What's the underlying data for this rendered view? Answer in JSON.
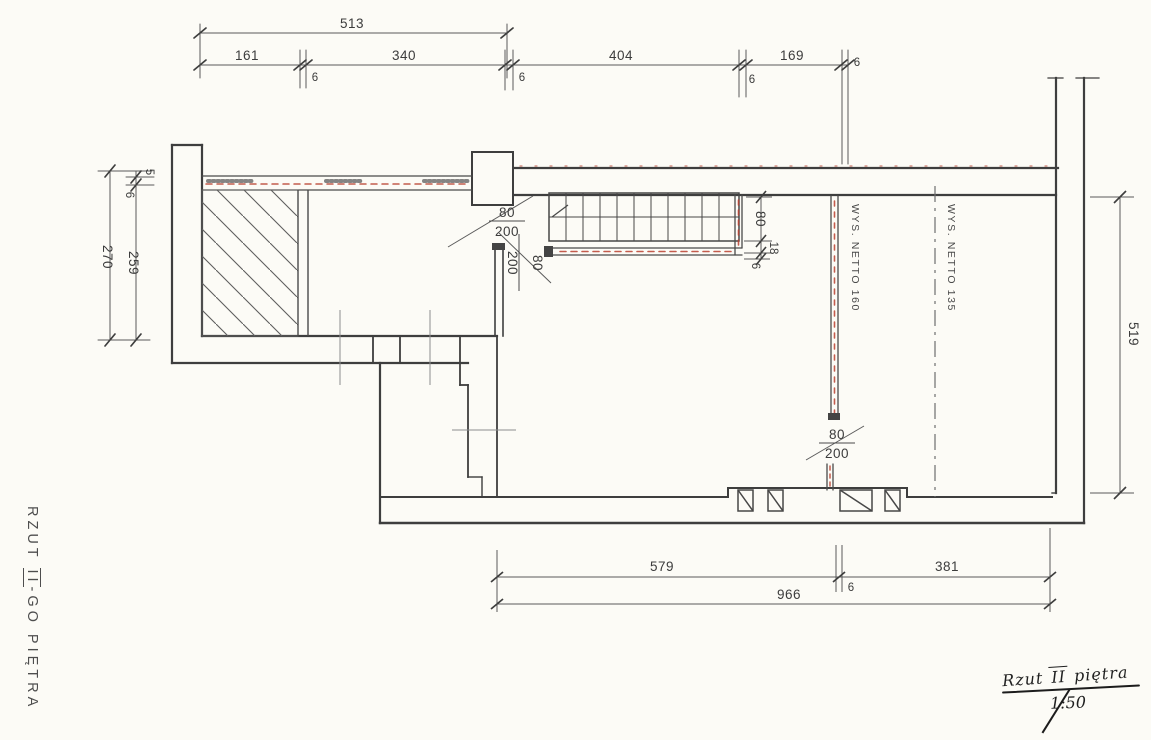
{
  "drawing_title": "RZUT II-go PIĘTRA (floor plan, scale 1:50)",
  "colors": {
    "paper": "#fcfbf6",
    "pencil": "#3e3e3e",
    "insulation_red": "#b9402f"
  },
  "dims": {
    "top": {
      "total": "513",
      "seg1": "161",
      "seg2": "340",
      "seg3": "404",
      "seg4": "169",
      "thin": "6"
    },
    "left": {
      "outer": "270",
      "inner": "259",
      "t5": "5",
      "t6": "6"
    },
    "right": {
      "height": "519"
    },
    "stair_side": {
      "w": "80",
      "landing": "18",
      "wall": "6"
    },
    "bottom": {
      "seg1": "579",
      "seg2": "381",
      "total": "966",
      "thin": "6"
    }
  },
  "doors": {
    "width": "80",
    "height": "200"
  },
  "annotations": {
    "wall_160": "WYS. NETTO 160",
    "axis_135": "WYS. NETTO 135"
  },
  "side_title": {
    "pre": "RZUT ",
    "numeral": "II",
    "post": "-GO PIĘTRA"
  },
  "title_block": {
    "pre": "Rzut ",
    "numeral": "II",
    "post": " piętra",
    "scale": "1:50"
  }
}
